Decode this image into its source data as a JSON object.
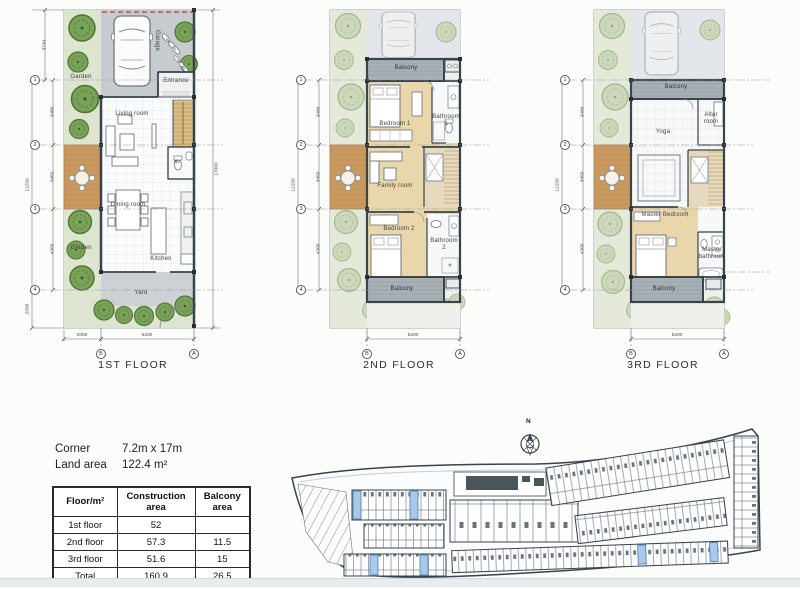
{
  "plans": [
    {
      "title": "1ST FLOOR",
      "labels": {
        "garden_top": "Garden",
        "garage": "Garage",
        "entrance": "Entrance",
        "living_room": "Living room",
        "wc": "wc",
        "garden_mid": "Garden",
        "dining_room": "Dining room",
        "kitchen": "Kitchen",
        "yard": "Yard"
      },
      "dims": {
        "v_total": "11230",
        "v_top": "3740",
        "v1": "3480",
        "v2": "3450",
        "v3": "4300",
        "v_bottom": "2000",
        "v_right": "17000",
        "w_garden": "2000",
        "w_house": "5200"
      },
      "grid": {
        "r1": "1",
        "r2": "2",
        "r3": "3",
        "r4": "4",
        "cb": "B",
        "ca": "A"
      }
    },
    {
      "title": "2ND FLOOR",
      "labels": {
        "balcony_top": "Balcony",
        "bedroom1": "Bedroom 1",
        "bathroom1": "Bathroom 1",
        "family_room": "Family room",
        "bedroom2": "Bedroom 2",
        "bathroom2": "Bathroom 2",
        "balcony_bottom": "Balcony"
      },
      "dims": {
        "v_total": "11230",
        "v1": "3480",
        "v2": "3450",
        "v3": "4300",
        "w_house": "5200"
      },
      "grid": {
        "r1": "1",
        "r2": "2",
        "r3": "3",
        "r4": "4",
        "cb": "B",
        "ca": "A"
      }
    },
    {
      "title": "3RD FLOOR",
      "labels": {
        "balcony_top": "Balcony",
        "yoga": "Yoga",
        "altar_room": "Altar room",
        "master_bedroom": "Master Bedroom",
        "master_bathroom": "Master bathroom",
        "balcony_bottom": "Balcony"
      },
      "dims": {
        "v_total": "11230",
        "v1": "3480",
        "v2": "3450",
        "v3": "4300",
        "w_house": "5200"
      },
      "grid": {
        "r1": "1",
        "r2": "2",
        "r3": "3",
        "r4": "4",
        "cb": "B",
        "ca": "A"
      }
    }
  ],
  "info": {
    "corner_label": "Corner",
    "corner_value": "7.2m x 17m",
    "land_area_label": "Land area",
    "land_area_value": "122.4 m²"
  },
  "table": {
    "headers": [
      "Floor/m²",
      "Construction area",
      "Balcony area"
    ],
    "rows": [
      {
        "floor": "1st floor",
        "construction": "52",
        "balcony": ""
      },
      {
        "floor": "2nd floor",
        "construction": "57.3",
        "balcony": "11.5"
      },
      {
        "floor": "3rd floor",
        "construction": "51.6",
        "balcony": "15"
      },
      {
        "floor": "Total",
        "construction": "160.9",
        "balcony": "26.5"
      }
    ]
  },
  "site": {
    "north_label": "N"
  },
  "colors": {
    "highlight_unit": "#a9c9ea",
    "deck_wood": "#c9995f",
    "tree_dark": "#79a258",
    "tree_light": "#ccd8bb",
    "balcony_gray": "#a7b0b5",
    "bedroom_floor": "#ead6ab",
    "site_line": "#39434a",
    "boundary_red": "#c2382e"
  }
}
